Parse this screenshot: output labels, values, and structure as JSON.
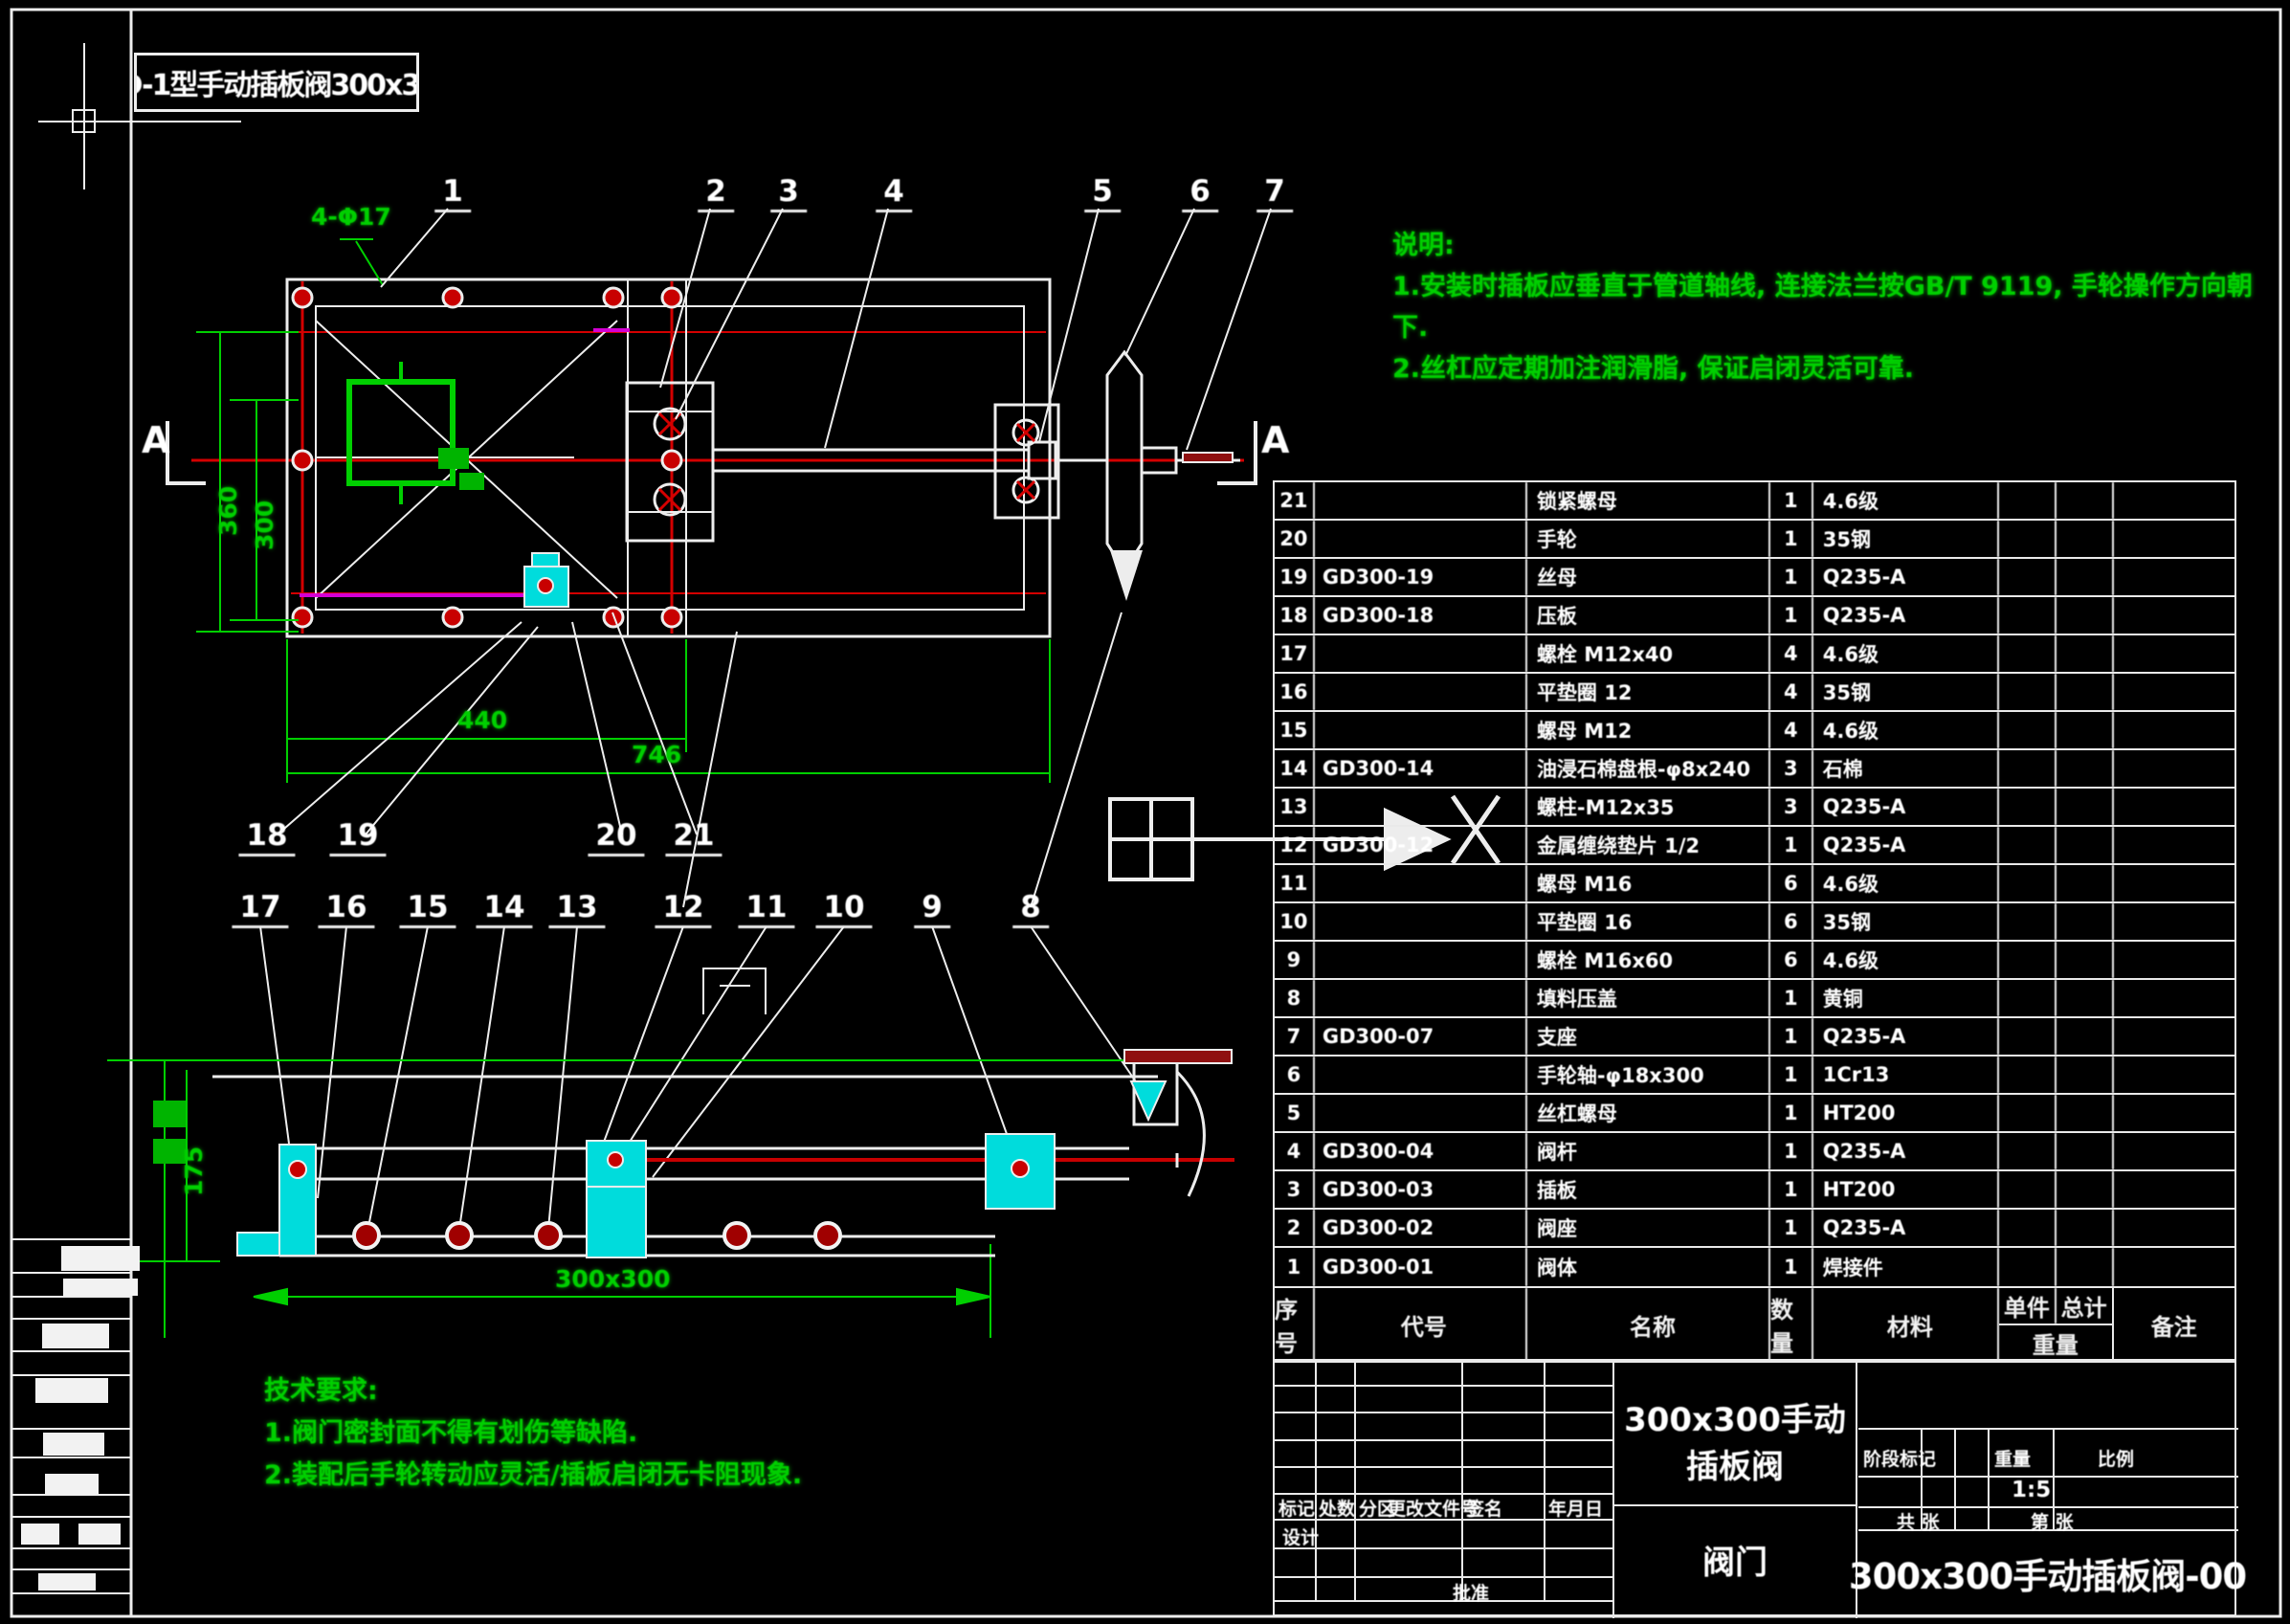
{
  "sheet": {
    "background": "#000000",
    "top_left_label": "GD-1型手动插板阀300x300",
    "section_label_left": "A",
    "section_label_right": "A"
  },
  "colors": {
    "line_white": "#ededed",
    "dim_green": "#00cf00",
    "center_red": "#d40000",
    "part_cyan": "#00dcdc",
    "seal_magenta": "#d400d4",
    "handle_dark_red": "#8f1010"
  },
  "notes_top_right": {
    "lines": [
      "说明:",
      "1.安装时插板应垂直于管道轴线, 连接法兰按GB/T 9119, 手轮操作方向朝",
      "下.",
      "2.丝杠应定期加注润滑脂, 保证启闭灵活可靠."
    ]
  },
  "notes_bottom_left": {
    "lines": [
      "技术要求:",
      "1.阀门密封面不得有划伤等缺陷.",
      "2.装配后手轮转动应灵活/插板启闭无卡阻现象."
    ]
  },
  "callouts": {
    "top": [
      "1",
      "2",
      "3",
      "4",
      "5",
      "6",
      "7"
    ],
    "mid": [
      "18",
      "19",
      "20",
      "21"
    ],
    "bottom": [
      "17",
      "16",
      "15",
      "14",
      "13",
      "12",
      "11",
      "10",
      "9",
      "8"
    ]
  },
  "dimensions": {
    "flange_holes": "4-Φ17",
    "top_view_width": "440",
    "top_view_total": "746",
    "top_view_height_outer": "360",
    "top_view_height_inner": "300",
    "section_width": "300x300",
    "section_height": "175"
  },
  "bom": {
    "header": {
      "seq": "序号",
      "code": "代号",
      "name": "名称",
      "qty": "数量",
      "mat": "材料",
      "unit": "单件",
      "total": "总计",
      "weight": "重量",
      "remark": "备注"
    },
    "rows": [
      {
        "seq": "21",
        "code": "",
        "name": "锁紧螺母",
        "qty": "1",
        "mat": "4.6级",
        "unit": "",
        "total": "",
        "remark": ""
      },
      {
        "seq": "20",
        "code": "",
        "name": "手轮",
        "qty": "1",
        "mat": "35钢",
        "unit": "",
        "total": "",
        "remark": ""
      },
      {
        "seq": "19",
        "code": "GD300-19",
        "name": "丝母",
        "qty": "1",
        "mat": "Q235-A",
        "unit": "",
        "total": "",
        "remark": ""
      },
      {
        "seq": "18",
        "code": "GD300-18",
        "name": "压板",
        "qty": "1",
        "mat": "Q235-A",
        "unit": "",
        "total": "",
        "remark": ""
      },
      {
        "seq": "17",
        "code": "",
        "name": "螺栓 M12x40",
        "qty": "4",
        "mat": "4.6级",
        "unit": "",
        "total": "",
        "remark": ""
      },
      {
        "seq": "16",
        "code": "",
        "name": "平垫圈 12",
        "qty": "4",
        "mat": "35钢",
        "unit": "",
        "total": "",
        "remark": ""
      },
      {
        "seq": "15",
        "code": "",
        "name": "螺母 M12",
        "qty": "4",
        "mat": "4.6级",
        "unit": "",
        "total": "",
        "remark": ""
      },
      {
        "seq": "14",
        "code": "GD300-14",
        "name": "油浸石棉盘根-φ8x240",
        "qty": "3",
        "mat": "石棉",
        "unit": "",
        "total": "",
        "remark": ""
      },
      {
        "seq": "13",
        "code": "",
        "name": "螺柱-M12x35",
        "qty": "3",
        "mat": "Q235-A",
        "unit": "",
        "total": "",
        "remark": ""
      },
      {
        "seq": "12",
        "code": "GD300-12",
        "name": "金属缠绕垫片 1/2",
        "qty": "1",
        "mat": "Q235-A",
        "unit": "",
        "total": "",
        "remark": ""
      },
      {
        "seq": "11",
        "code": "",
        "name": "螺母 M16",
        "qty": "6",
        "mat": "4.6级",
        "unit": "",
        "total": "",
        "remark": ""
      },
      {
        "seq": "10",
        "code": "",
        "name": "平垫圈 16",
        "qty": "6",
        "mat": "35钢",
        "unit": "",
        "total": "",
        "remark": ""
      },
      {
        "seq": "9",
        "code": "",
        "name": "螺栓 M16x60",
        "qty": "6",
        "mat": "4.6级",
        "unit": "",
        "total": "",
        "remark": ""
      },
      {
        "seq": "8",
        "code": "",
        "name": "填料压盖",
        "qty": "1",
        "mat": "黄铜",
        "unit": "",
        "total": "",
        "remark": ""
      },
      {
        "seq": "7",
        "code": "GD300-07",
        "name": "支座",
        "qty": "1",
        "mat": "Q235-A",
        "unit": "",
        "total": "",
        "remark": ""
      },
      {
        "seq": "6",
        "code": "",
        "name": "手轮轴-φ18x300",
        "qty": "1",
        "mat": "1Cr13",
        "unit": "",
        "total": "",
        "remark": ""
      },
      {
        "seq": "5",
        "code": "",
        "name": "丝杠螺母",
        "qty": "1",
        "mat": "HT200",
        "unit": "",
        "total": "",
        "remark": ""
      },
      {
        "seq": "4",
        "code": "GD300-04",
        "name": "阀杆",
        "qty": "1",
        "mat": "Q235-A",
        "unit": "",
        "total": "",
        "remark": ""
      },
      {
        "seq": "3",
        "code": "GD300-03",
        "name": "插板",
        "qty": "1",
        "mat": "HT200",
        "unit": "",
        "total": "",
        "remark": ""
      },
      {
        "seq": "2",
        "code": "GD300-02",
        "name": "阀座",
        "qty": "1",
        "mat": "Q235-A",
        "unit": "",
        "total": "",
        "remark": ""
      },
      {
        "seq": "1",
        "code": "GD300-01",
        "name": "阀体",
        "qty": "1",
        "mat": "焊接件",
        "unit": "",
        "total": "",
        "remark": ""
      }
    ]
  },
  "title_block": {
    "product": "300x300手动插板阀",
    "subtitle": "阀门",
    "drawing_no": "300x300手动插板阀-00",
    "scale_value": "1:5",
    "stage_label": "阶段标记",
    "weight_label": "重量",
    "scale_label": "比例",
    "sheet_label_1": "共 张",
    "sheet_label_2": "第 张",
    "revision_labels": [
      "标记",
      "处数",
      "分区",
      "更改文件号",
      "签名",
      "年月日"
    ],
    "design_label": "设计",
    "approve_label": "批准"
  }
}
